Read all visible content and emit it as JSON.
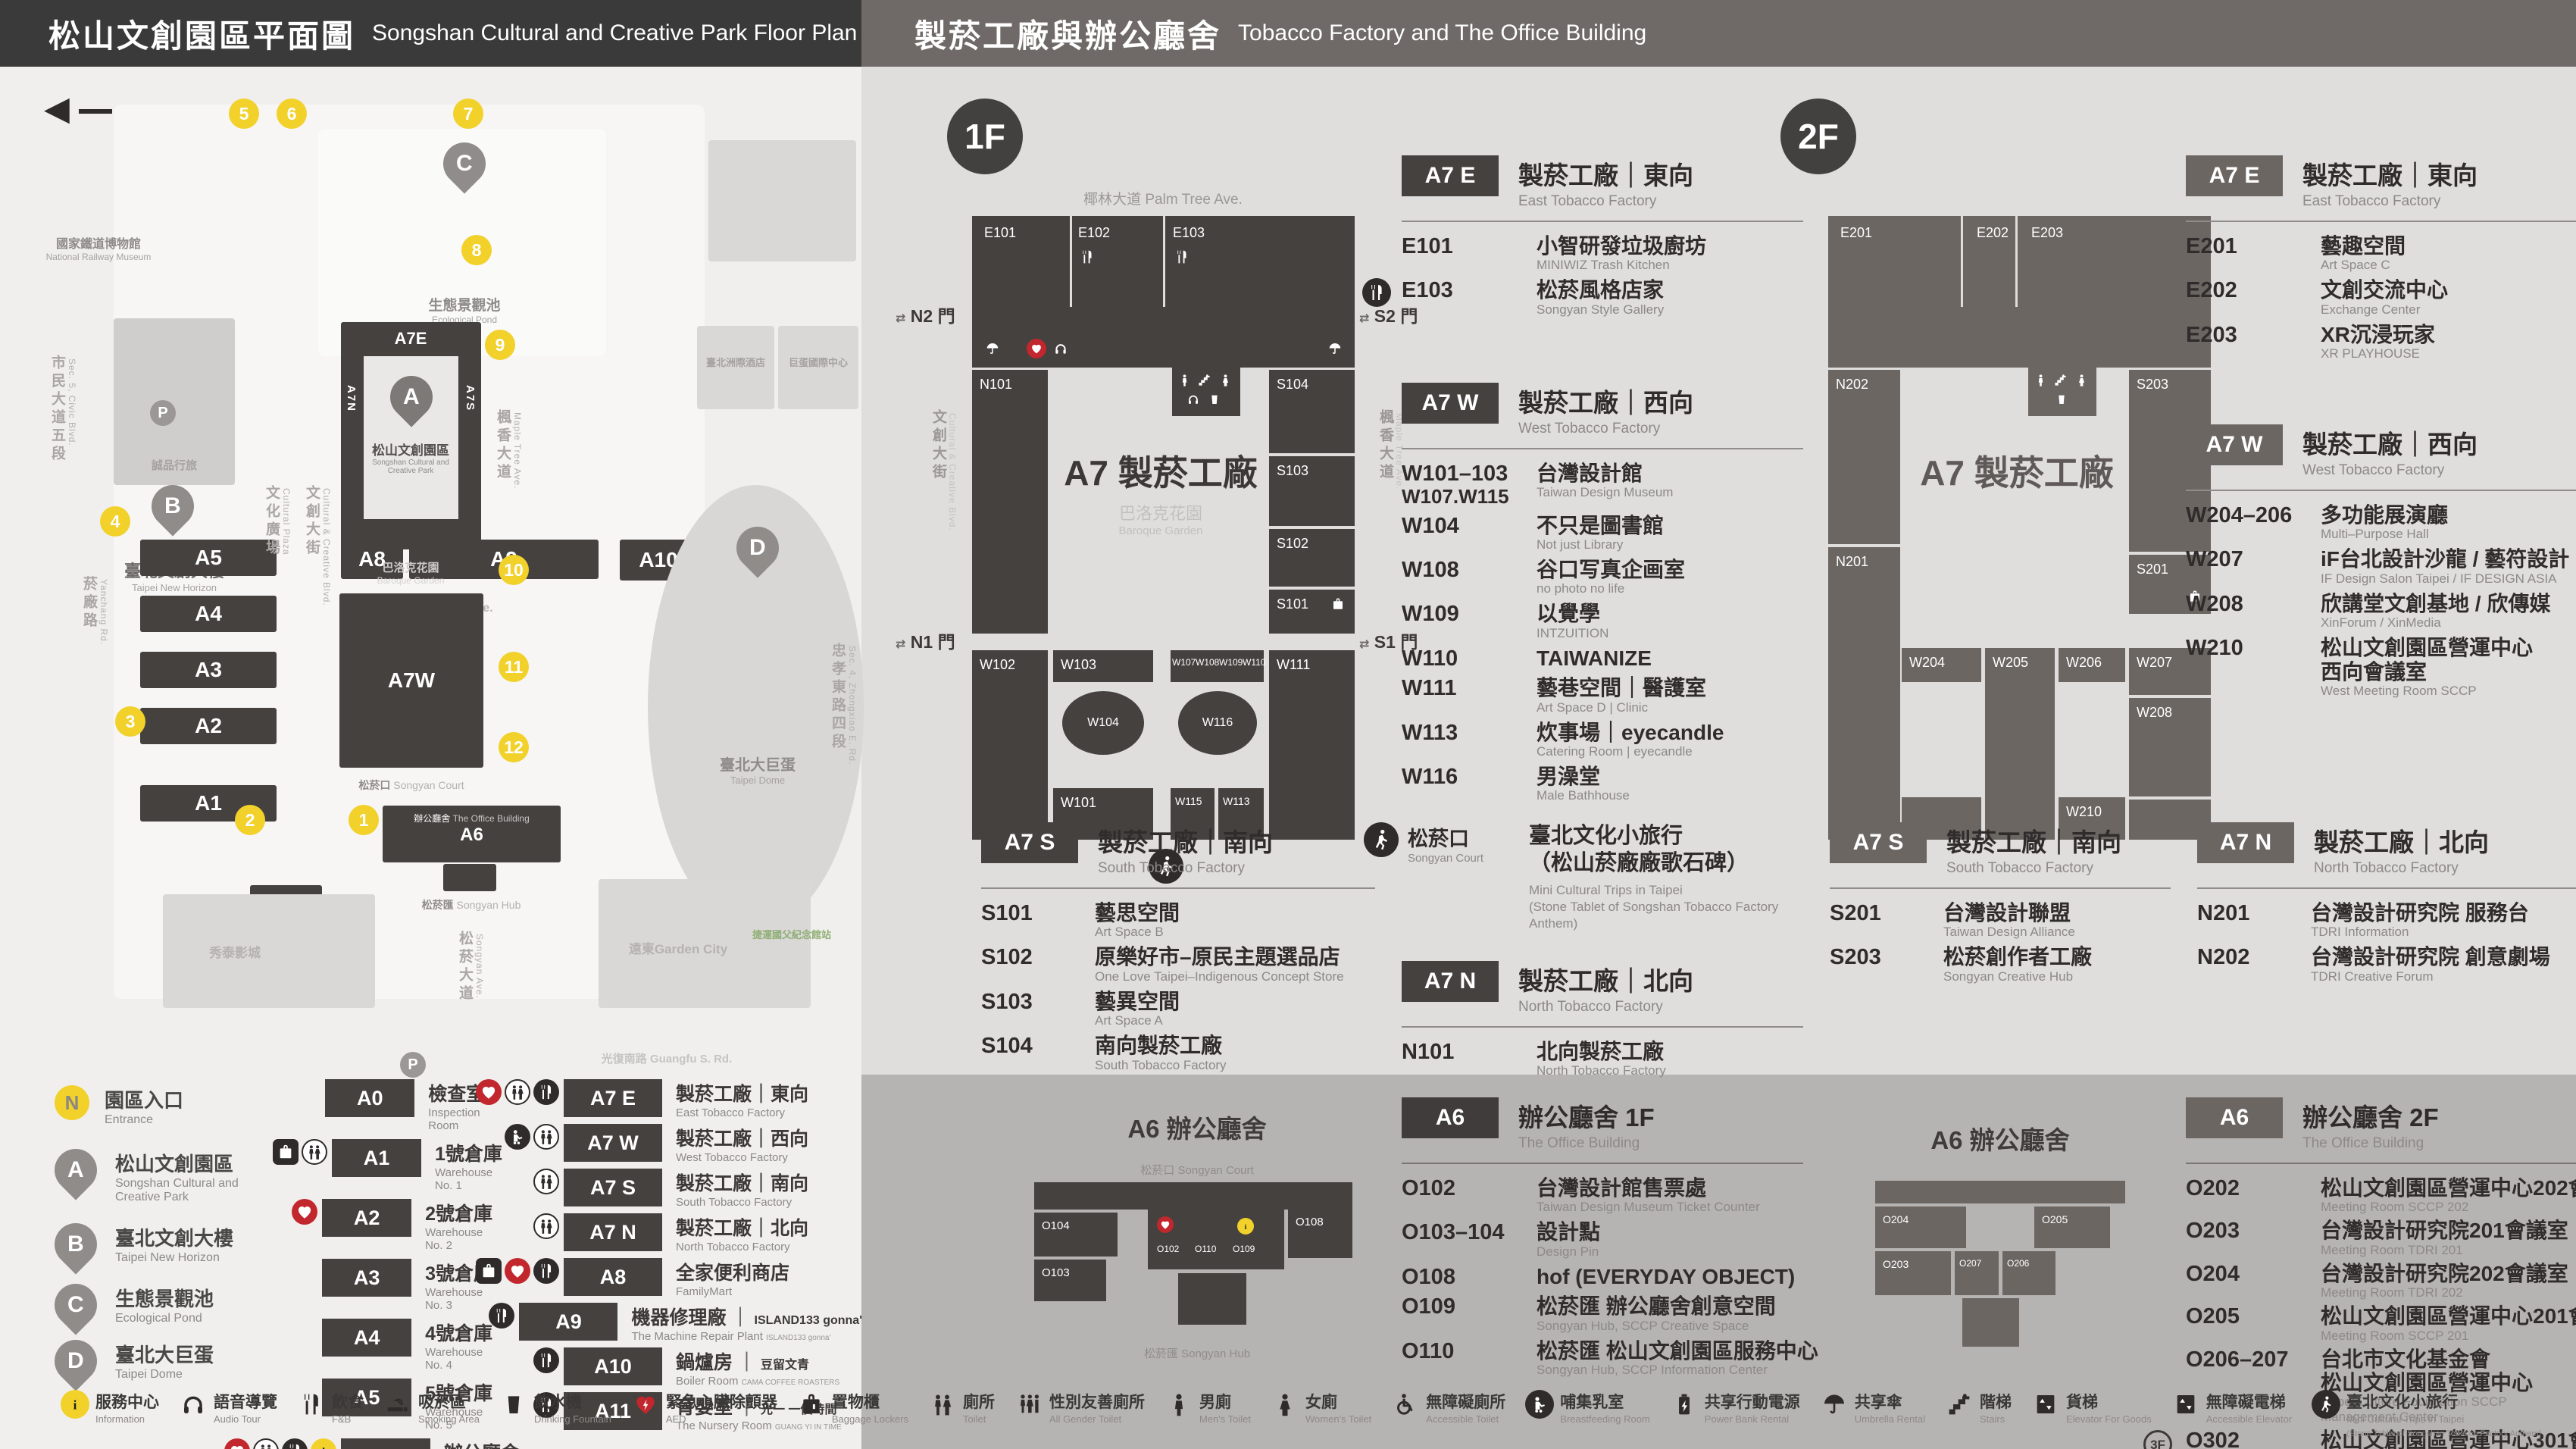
{
  "header": {
    "left_zh": "松山文創園區平面圖",
    "left_en": "Songshan Cultural and Creative Park Floor Plan",
    "right_zh": "製菸工廠與辦公廳舍",
    "right_en": "Tobacco Factory and The Office Building"
  },
  "map": {
    "parking": "P",
    "markers": [
      "1",
      "2",
      "3",
      "4",
      "5",
      "6",
      "7",
      "8",
      "9",
      "10",
      "11",
      "12"
    ],
    "streets": {
      "palm": "椰林大道 Palm Tree Ave.",
      "cultural_plaza_zh": "文化廣場",
      "cultural_plaza_en": "Cultural Plaza",
      "blvd_zh": "文創大街",
      "blvd_en": "Cultural & Creative Blvd.",
      "maple_zh": "楓香大道",
      "maple_en": "Maple Tree Ave.",
      "yanchang_zh": "菸廠路",
      "yanchang_en": "Yanchang Rd.",
      "civic_zh": "市民大道五段",
      "civic_en": "Sec. 5, Civic Blvd.",
      "guangfu": "光復南路 Guangfu S. Rd.",
      "zhongxiao_zh": "忠孝東路四段",
      "zhongxiao_en": "Sec. 4, Zhongxiao E. Rd.",
      "songyan_zh": "松菸大道",
      "songyan_en": "Songyan Ave."
    },
    "pois": {
      "railway_zh": "國家鐵道博物館",
      "railway_en": "National Railway Museum",
      "eslite_hotel": "誠品行旅",
      "b_zh": "臺北文創大樓",
      "b_en": "Taipei New Horizon",
      "eslite_store": "誠品生活松菸",
      "c_zh": "生態景觀池",
      "c_en": "Ecological Pond",
      "a_zh": "松山文創園區",
      "a_en1": "Songshan Cultural and",
      "a_en2": "Creative Park",
      "garden_zh": "巴洛克花園",
      "garden_en": "Baroque Garden",
      "court_zh": "松菸口",
      "court_en": "Songyan Court",
      "office_zh": "辦公廳舍",
      "office_en": "The Office Building",
      "hub_zh": "松菸匯",
      "hub_en": "Songyan Hub",
      "dome_zh": "臺北大巨蛋",
      "dome_en": "Taipei Dome",
      "hotel1": "臺北洲際酒店",
      "hotel2": "巨蛋國際中心",
      "cinema": "秀泰影城",
      "gardencity": "遠東Garden City",
      "mrt": "捷運國父紀念館站"
    },
    "buildings": {
      "a0": "A0",
      "a1": "A1",
      "a2": "A2",
      "a3": "A3",
      "a4": "A4",
      "a5": "A5",
      "a6": "A6",
      "a7e": "A7E",
      "a7w": "A7W",
      "a7n": "A7N",
      "a7s": "A7S",
      "a8": "A8",
      "a9": "A9",
      "a10": "A10",
      "a11": "A11"
    }
  },
  "legend": {
    "entrance": {
      "symbol": "N",
      "zh": "園區入口",
      "en": "Entrance"
    },
    "pins": [
      {
        "letter": "A",
        "zh": "松山文創園區",
        "en": "Songshan Cultural and Creative Park"
      },
      {
        "letter": "B",
        "zh": "臺北文創大樓",
        "en": "Taipei New Horizon"
      },
      {
        "letter": "C",
        "zh": "生態景觀池",
        "en": "Ecological Pond"
      },
      {
        "letter": "D",
        "zh": "臺北大巨蛋",
        "en": "Taipei Dome"
      }
    ],
    "col1": [
      {
        "code": "A0",
        "zh": "檢查室",
        "en": "Inspection Room"
      },
      {
        "code": "A1",
        "zh": "1號倉庫",
        "en": "Warehouse No. 1",
        "locker": true,
        "toilet": true
      },
      {
        "code": "A2",
        "zh": "2號倉庫",
        "en": "Warehouse No. 2",
        "aed": true
      },
      {
        "code": "A3",
        "zh": "3號倉庫",
        "en": "Warehouse No. 3"
      },
      {
        "code": "A4",
        "zh": "4號倉庫",
        "en": "Warehouse No. 4"
      },
      {
        "code": "A5",
        "zh": "5號倉庫",
        "en": "Warehouse No. 5"
      },
      {
        "code": "A6",
        "zh": "辦公廳舍",
        "en": "The Office Building",
        "aed": true,
        "toilet": true,
        "fnb": true,
        "info": true
      }
    ],
    "col2": [
      {
        "code": "A7 E",
        "zh": "製菸工廠｜東向",
        "en": "East Tobacco Factory",
        "aed": true,
        "toilet": true,
        "fnb": true
      },
      {
        "code": "A7 W",
        "zh": "製菸工廠｜西向",
        "en": "West Tobacco Factory",
        "nursing": true,
        "toilet": true
      },
      {
        "code": "A7 S",
        "zh": "製菸工廠｜南向",
        "en": "South Tobacco Factory",
        "toilet": true
      },
      {
        "code": "A7 N",
        "zh": "製菸工廠｜北向",
        "en": "North Tobacco Factory",
        "toilet": true
      },
      {
        "code": "A8",
        "zh": "全家便利商店",
        "en": "FamilyMart",
        "locker": true,
        "aed": true,
        "fnb": true
      },
      {
        "code": "A9",
        "zh": "機器修理廠",
        "zh2": "ISLAND133 gonna'",
        "en": "The Machine Repair Plant",
        "en2": "ISLAND133 gonna'",
        "fnb": true
      },
      {
        "code": "A10",
        "zh": "鍋爐房",
        "zh2": "豆留文青",
        "en": "Boiler Room",
        "en2": "CAMA COFFEE ROASTERS",
        "fnb": true
      },
      {
        "code": "A11",
        "zh": "育嬰室",
        "zh2": "光一 一個時間",
        "en": "The Nursery Room",
        "en2": "GUANG YI IN TIME",
        "fnb": true
      }
    ]
  },
  "floor1": {
    "label": "1F",
    "plan": {
      "street_top": "椰林大道 Palm Tree Ave.",
      "street_left_zh": "文創大街",
      "street_left_en": "Cultural & Creative Blvd.",
      "street_right_zh": "楓香大道",
      "street_right_en": "Maple Tree Ave.",
      "center": "A7 製菸工廠",
      "garden_zh": "巴洛克花園",
      "garden_en": "Baroque Garden",
      "arrow": "⇄",
      "gates": {
        "n2": "N2 門",
        "s2": "S2 門",
        "n1": "N1 門",
        "s1": "S1 門"
      },
      "rooms": {
        "e101": "E101",
        "e102": "E102",
        "e103": "E103",
        "n101": "N101",
        "w102": "W102",
        "s104": "S104",
        "s103": "S103",
        "s102": "S102",
        "s101": "S101",
        "w111": "W111",
        "w103": "W103",
        "w104": "W104",
        "w101": "W101",
        "w107": "W107",
        "w108": "W108",
        "w109": "W109",
        "w110": "W110",
        "w116": "W116",
        "w115": "W115",
        "w113": "W113"
      }
    },
    "east": {
      "badge": "A7 E",
      "zh": "製菸工廠｜東向",
      "en": "East Tobacco Factory",
      "items": [
        {
          "code": "E101",
          "zh": "小智研發垃圾廚坊",
          "en": "MINIWIZ Trash Kitchen"
        },
        {
          "code": "E103",
          "fnb": true,
          "zh": "松菸風格店家",
          "en": "Songyan Style Gallery"
        }
      ]
    },
    "west": {
      "badge": "A7 W",
      "zh": "製菸工廠｜西向",
      "en": "West Tobacco Factory",
      "items": [
        {
          "code": "W101–103",
          "code2": "W107.W115",
          "zh": "台灣設計館",
          "en": "Taiwan Design Museum"
        },
        {
          "code": "W104",
          "zh": "不只是圖書館",
          "en": "Not just Library"
        },
        {
          "code": "W108",
          "zh": "谷口写真企画室",
          "en": "no photo no life"
        },
        {
          "code": "W109",
          "zh": "以覺學",
          "en": "INTZUITION"
        },
        {
          "code": "W110",
          "zh": "TAIWANIZE"
        },
        {
          "code": "W111",
          "zh": "藝巷空間｜醫護室",
          "en": "Art Space D | Clinic"
        },
        {
          "code": "W113",
          "zh": "炊事場｜eyecandle",
          "en": "Catering Room | eyecandle"
        },
        {
          "code": "W116",
          "zh": "男澡堂",
          "en": "Male Bathhouse"
        }
      ]
    },
    "south": {
      "badge": "A7 S",
      "zh": "製菸工廠｜南向",
      "en": "South Tobacco Factory",
      "items": [
        {
          "code": "S101",
          "zh": "藝思空間",
          "en": "Art Space B"
        },
        {
          "code": "S102",
          "zh": "原樂好市–原民主題選品店",
          "en": "One Love Taipei–Indigenous Concept Store"
        },
        {
          "code": "S103",
          "zh": "藝異空間",
          "en": "Art Space A"
        },
        {
          "code": "S104",
          "zh": "南向製菸工廠",
          "en": "South Tobacco Factory"
        }
      ]
    },
    "north": {
      "badge": "A7 N",
      "zh": "製菸工廠｜北向",
      "en": "North Tobacco Factory",
      "items": [
        {
          "code": "N101",
          "zh": "北向製菸工廠",
          "en": "North Tobacco Factory"
        }
      ]
    },
    "court": {
      "zh": "松菸口",
      "en": "Songyan Court",
      "name_zh": "臺北文化小旅行",
      "name_zh2": "（松山菸廠廠歌石碑）",
      "name_en": "Mini Cultural Trips in Taipei",
      "name_en2": "(Stone Tablet of Songshan Tobacco Factory Anthem)"
    }
  },
  "floor2": {
    "label": "2F",
    "plan": {
      "center": "A7 製菸工廠",
      "rooms": {
        "e201": "E201",
        "e202": "E202",
        "e203": "E203",
        "n202": "N202",
        "n201": "N201",
        "s203": "S203",
        "s201": "S201",
        "w204": "W204",
        "w205": "W205",
        "w206": "W206",
        "w207": "W207",
        "w208": "W208",
        "w210": "W210"
      }
    },
    "east": {
      "badge": "A7 E",
      "zh": "製菸工廠｜東向",
      "en": "East Tobacco Factory",
      "items": [
        {
          "code": "E201",
          "zh": "藝趣空間",
          "en": "Art Space C"
        },
        {
          "code": "E202",
          "zh": "文創交流中心",
          "en": "Exchange Center"
        },
        {
          "code": "E203",
          "zh": "XR沉浸玩家",
          "en": "XR PLAYHOUSE"
        }
      ]
    },
    "west": {
      "badge": "A7 W",
      "zh": "製菸工廠｜西向",
      "en": "West Tobacco Factory",
      "items": [
        {
          "code": "W204–206",
          "zh": "多功能展演廳",
          "en": "Multi–Purpose Hall"
        },
        {
          "code": "W207",
          "zh": "iF台北設計沙龍 / 藝符設計",
          "en": "IF Design Salon Taipei / IF DESIGN ASIA"
        },
        {
          "code": "W208",
          "zh": "欣講堂文創基地 / 欣傳媒",
          "en": "XinForum / XinMedia"
        },
        {
          "code": "W210",
          "zh": "松山文創園區營運中心",
          "zh2": "西向會議室",
          "en": "West Meeting Room SCCP"
        }
      ]
    },
    "south": {
      "badge": "A7 S",
      "zh": "製菸工廠｜南向",
      "en": "South Tobacco Factory",
      "items": [
        {
          "code": "S201",
          "zh": "台灣設計聯盟",
          "en": "Taiwan Design Alliance"
        },
        {
          "code": "S203",
          "zh": "松菸創作者工廠",
          "en": "Songyan Creative Hub"
        }
      ]
    },
    "north": {
      "badge": "A7 N",
      "zh": "製菸工廠｜北向",
      "en": "North Tobacco Factory",
      "items": [
        {
          "code": "N201",
          "zh": "台灣設計研究院 服務台",
          "en": "TDRI Information"
        },
        {
          "code": "N202",
          "zh": "台灣設計研究院 創意劇場",
          "en": "TDRI Creative Forum"
        }
      ]
    }
  },
  "office1": {
    "title": "A6 辦公廳舍",
    "court_zh": "松菸口",
    "court_en": "Songyan Court",
    "hub_zh": "松菸匯",
    "hub_en": "Songyan Hub",
    "rooms": {
      "o104": "O104",
      "o103": "O103",
      "o102": "O102",
      "o110": "O110",
      "o109": "O109",
      "o108": "O108"
    },
    "listing": {
      "badge": "A6",
      "zh": "辦公廳舍 1F",
      "en": "The Office Building",
      "items": [
        {
          "code": "O102",
          "zh": "台灣設計館售票處",
          "en": "Taiwan Design Museum Ticket Counter"
        },
        {
          "code": "O103–104",
          "zh": "設計點",
          "en": "Design Pin"
        },
        {
          "code": "O108",
          "zh": "hof (EVERYDAY OBJECT)"
        },
        {
          "code": "O109",
          "zh": "松菸匯 辦公廳舍創意空間",
          "en": "Songyan Hub, SCCP Creative Space"
        },
        {
          "code": "O110",
          "zh": "松菸匯 松山文創園區服務中心",
          "en": "Songyan Hub, SCCP Information Center"
        }
      ]
    }
  },
  "office2": {
    "title": "A6 辦公廳舍",
    "rooms": {
      "o204": "O204",
      "o205": "O205",
      "o203": "O203",
      "o207": "O207",
      "o206": "O206"
    },
    "listing": {
      "badge": "A6",
      "zh": "辦公廳舍 2F",
      "en": "The Office Building",
      "items": [
        {
          "code": "O202",
          "zh": "松山文創園區營運中心202會議室",
          "en": "Meeting Room SCCP 202"
        },
        {
          "code": "O203",
          "zh": "台灣設計研究院201會議室",
          "en": "Meeting Room TDRI 201"
        },
        {
          "code": "O204",
          "zh": "台灣設計研究院202會議室",
          "en": "Meeting Room TDRI 202"
        },
        {
          "code": "O205",
          "zh": "松山文創園區營運中心201會議室",
          "en": "Meeting Room SCCP 201"
        },
        {
          "code": "O206–207",
          "zh": "台北市文化基金會",
          "zh2": "松山文創園區營運中心",
          "en": "Taipei Culture Foundation SCCP Management Center"
        },
        {
          "code": "O302",
          "badge": "3F",
          "zh": "松山文創園區營運中心301會議室",
          "en": "Meeting Room SCCP 301"
        }
      ]
    }
  },
  "strip": {
    "items": [
      {
        "icon": "information-icon",
        "zh": "服務中心",
        "en": "Information"
      },
      {
        "icon": "audio-tour-icon",
        "zh": "語音導覽",
        "en": "Audio Tour"
      },
      {
        "icon": "food-icon",
        "zh": "飲食",
        "en": "F&B"
      },
      {
        "icon": "smoking-area-icon",
        "zh": "吸菸區",
        "en": "Smoking Area"
      },
      {
        "icon": "drinking-fountain-icon",
        "zh": "飲水機",
        "en": "Drinking Fountain"
      },
      {
        "icon": "aed-icon",
        "zh": "緊急心臟除顫器",
        "en": "AED"
      },
      {
        "icon": "baggage-lockers-icon",
        "zh": "置物櫃",
        "en": "Baggage Lockers"
      },
      {
        "icon": "toilet-icon",
        "zh": "廁所",
        "en": "Toilet"
      },
      {
        "icon": "all-gender-toilet-icon",
        "zh": "性別友善廁所",
        "en": "All Gender Toilet"
      },
      {
        "icon": "mens-toilet-icon",
        "zh": "男廁",
        "en": "Men's Toilet"
      },
      {
        "icon": "womens-toilet-icon",
        "zh": "女廁",
        "en": "Women's Toilet"
      },
      {
        "icon": "accessible-toilet-icon",
        "zh": "無障礙廁所",
        "en": "Accessible Toilet"
      },
      {
        "icon": "breastfeeding-room-icon",
        "zh": "哺集乳室",
        "en": "Breastfeeding Room"
      },
      {
        "icon": "power-bank-rental-icon",
        "zh": "共享行動電源",
        "en": "Power Bank Rental"
      },
      {
        "icon": "umbrella-rental-icon",
        "zh": "共享傘",
        "en": "Umbrella Rental"
      },
      {
        "icon": "stairs-icon",
        "zh": "階梯",
        "en": "Stairs"
      },
      {
        "icon": "goods-elevator-icon",
        "zh": "貨梯",
        "en": "Elevator For Goods"
      },
      {
        "icon": "accessible-elevator-icon",
        "zh": "無障礙電梯",
        "en": "Accessible Elevator"
      },
      {
        "icon": "mini-cultural-trips-icon",
        "zh": "臺北文化小旅行",
        "en": "Mini Cultural Trips in Taipei",
        "en2": "(Stone Tablet of Songshan Tobacco Factory Anthem)"
      }
    ]
  }
}
